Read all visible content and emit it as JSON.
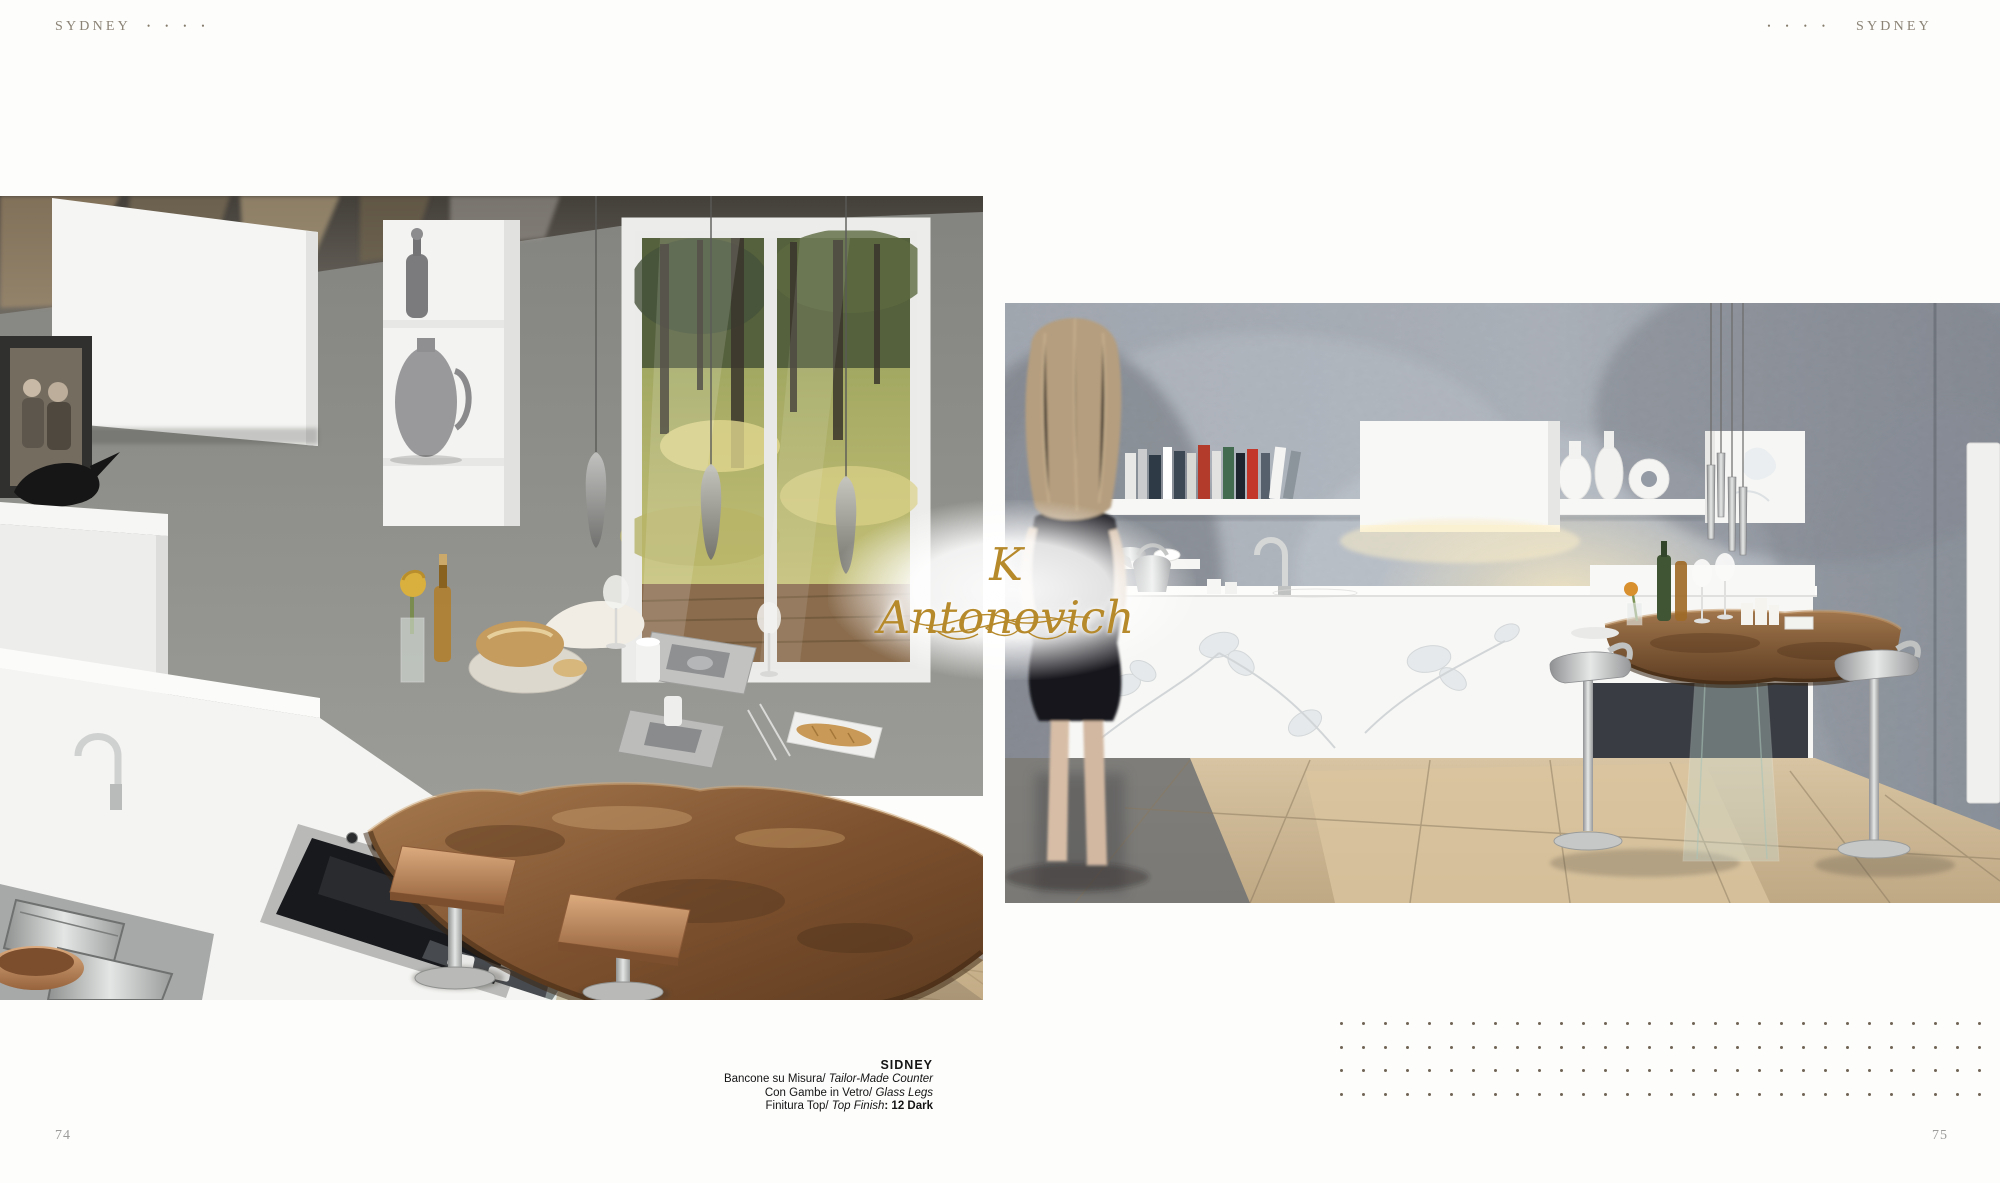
{
  "page": {
    "header_left": {
      "label": "SYDNEY",
      "dots": "••••"
    },
    "header_right": {
      "label": "SYDNEY",
      "dots": "••••"
    },
    "page_number_left": "74",
    "page_number_right": "75",
    "watermark": {
      "text": "K Antonovich"
    },
    "caption": {
      "title": "SIDNEY",
      "lines": [
        {
          "regular": "Bancone su Misura/",
          "italic": " Tailor-Made Counter",
          "suffix": ""
        },
        {
          "regular": "Con Gambe in Vetro/",
          "italic": " Glass Legs",
          "suffix": ""
        },
        {
          "regular": "Finitura Top/",
          "italic": " Top Finish",
          "suffix": ": 12 Dark"
        }
      ]
    },
    "dot_grid": {
      "rows": 4,
      "cols": 30
    },
    "colors": {
      "background": "#fdfdfc",
      "header_text": "#8a8274",
      "caption_text": "#141414",
      "page_number": "#9b9b99",
      "watermark_gold": "#b6892b",
      "pattern_dot": "#6f6354"
    }
  }
}
